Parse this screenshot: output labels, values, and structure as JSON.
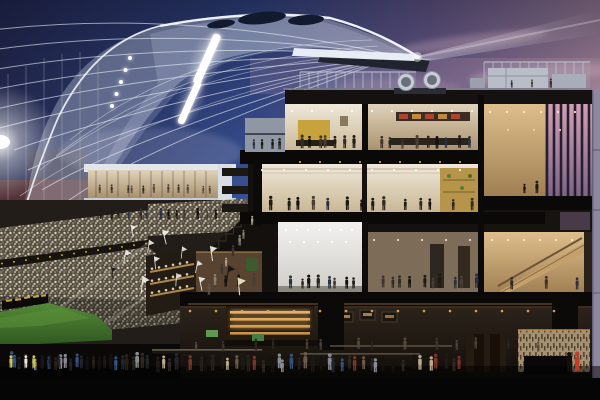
{
  "scene": {
    "description": "Dusk architectural cutaway rendering of a soccer stadium: a swooping white canopy over crowded stands and a sliver of green pitch at left, a multi-story hospitality building shown in cross-section with warmly lit interiors full of people, a rooftop terrace with mechanical equipment and a spotlight beam, and a dark ground-level concourse crowded with walking fans."
  },
  "colors": {
    "sky_top": "#262b52",
    "sky_blue": "#3a549a",
    "sky_violet": "#8872a3",
    "sky_pink": "#d6a8ba",
    "canopy": "#e9edf6",
    "glow": "#ffffff",
    "slab": "#0a0908",
    "structure": "#141110",
    "interior_light": "#efe8da",
    "interior_mid": "#c9b795",
    "white_room_light": "#f2f1ee",
    "white_room_dark": "#cfcdc8",
    "gold": "#c8a23c",
    "amber": "#e5b169",
    "red_sign": "#ad452e",
    "pitch_light": "#548a37",
    "pitch_dark": "#2f5720",
    "glass_pink": "#d29fb2",
    "glass_violet": "#7e6488",
    "wood_light": "#dfbe8c",
    "wood_dark": "#a07f52",
    "facade": "#8e87a0",
    "crowd_base": "#544e40",
    "maroon_wall": "#5a3434"
  }
}
